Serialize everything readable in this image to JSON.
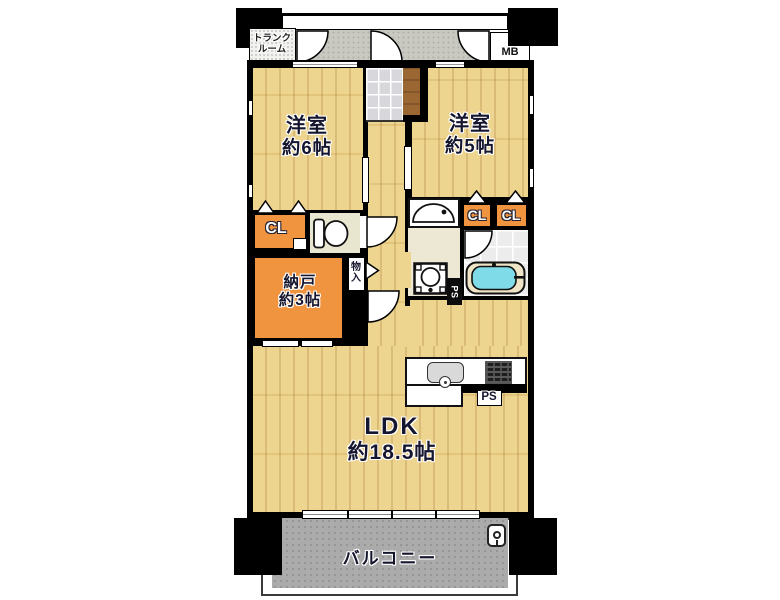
{
  "plan": {
    "trunk_room": {
      "line1": "トランク",
      "line2": "ルーム"
    },
    "meter_box": "MB",
    "bedroom1": {
      "name": "洋室",
      "area": "約6帖"
    },
    "bedroom2": {
      "name": "洋室",
      "area": "約5帖"
    },
    "closet_left": "CL",
    "closet_right_1": "CL",
    "closet_right_2": "CL",
    "storage_room": {
      "name": "納戸",
      "area": "約3帖"
    },
    "storage_small": {
      "line1": "物",
      "line2": "入"
    },
    "pipe_space_bath": "PS",
    "pipe_space_kitchen": "PS",
    "ldk": {
      "name": "LDK",
      "area": "約18.5帖"
    },
    "balcony": "バルコニー"
  },
  "colors": {
    "wall": "#000000",
    "wood": "#ecd086",
    "closet_orange": "#f09440",
    "corridor_gray": "#c9c9c1",
    "balcony_gray": "#ababab",
    "entrance_tile": "#d8d8dc",
    "step_wood_brown": "#9a6632",
    "bathtub_cyan": "#7fdbe8",
    "washroom_beige": "#ede8d4",
    "bath_tile": "#ececec",
    "label_text": "#15152e"
  }
}
